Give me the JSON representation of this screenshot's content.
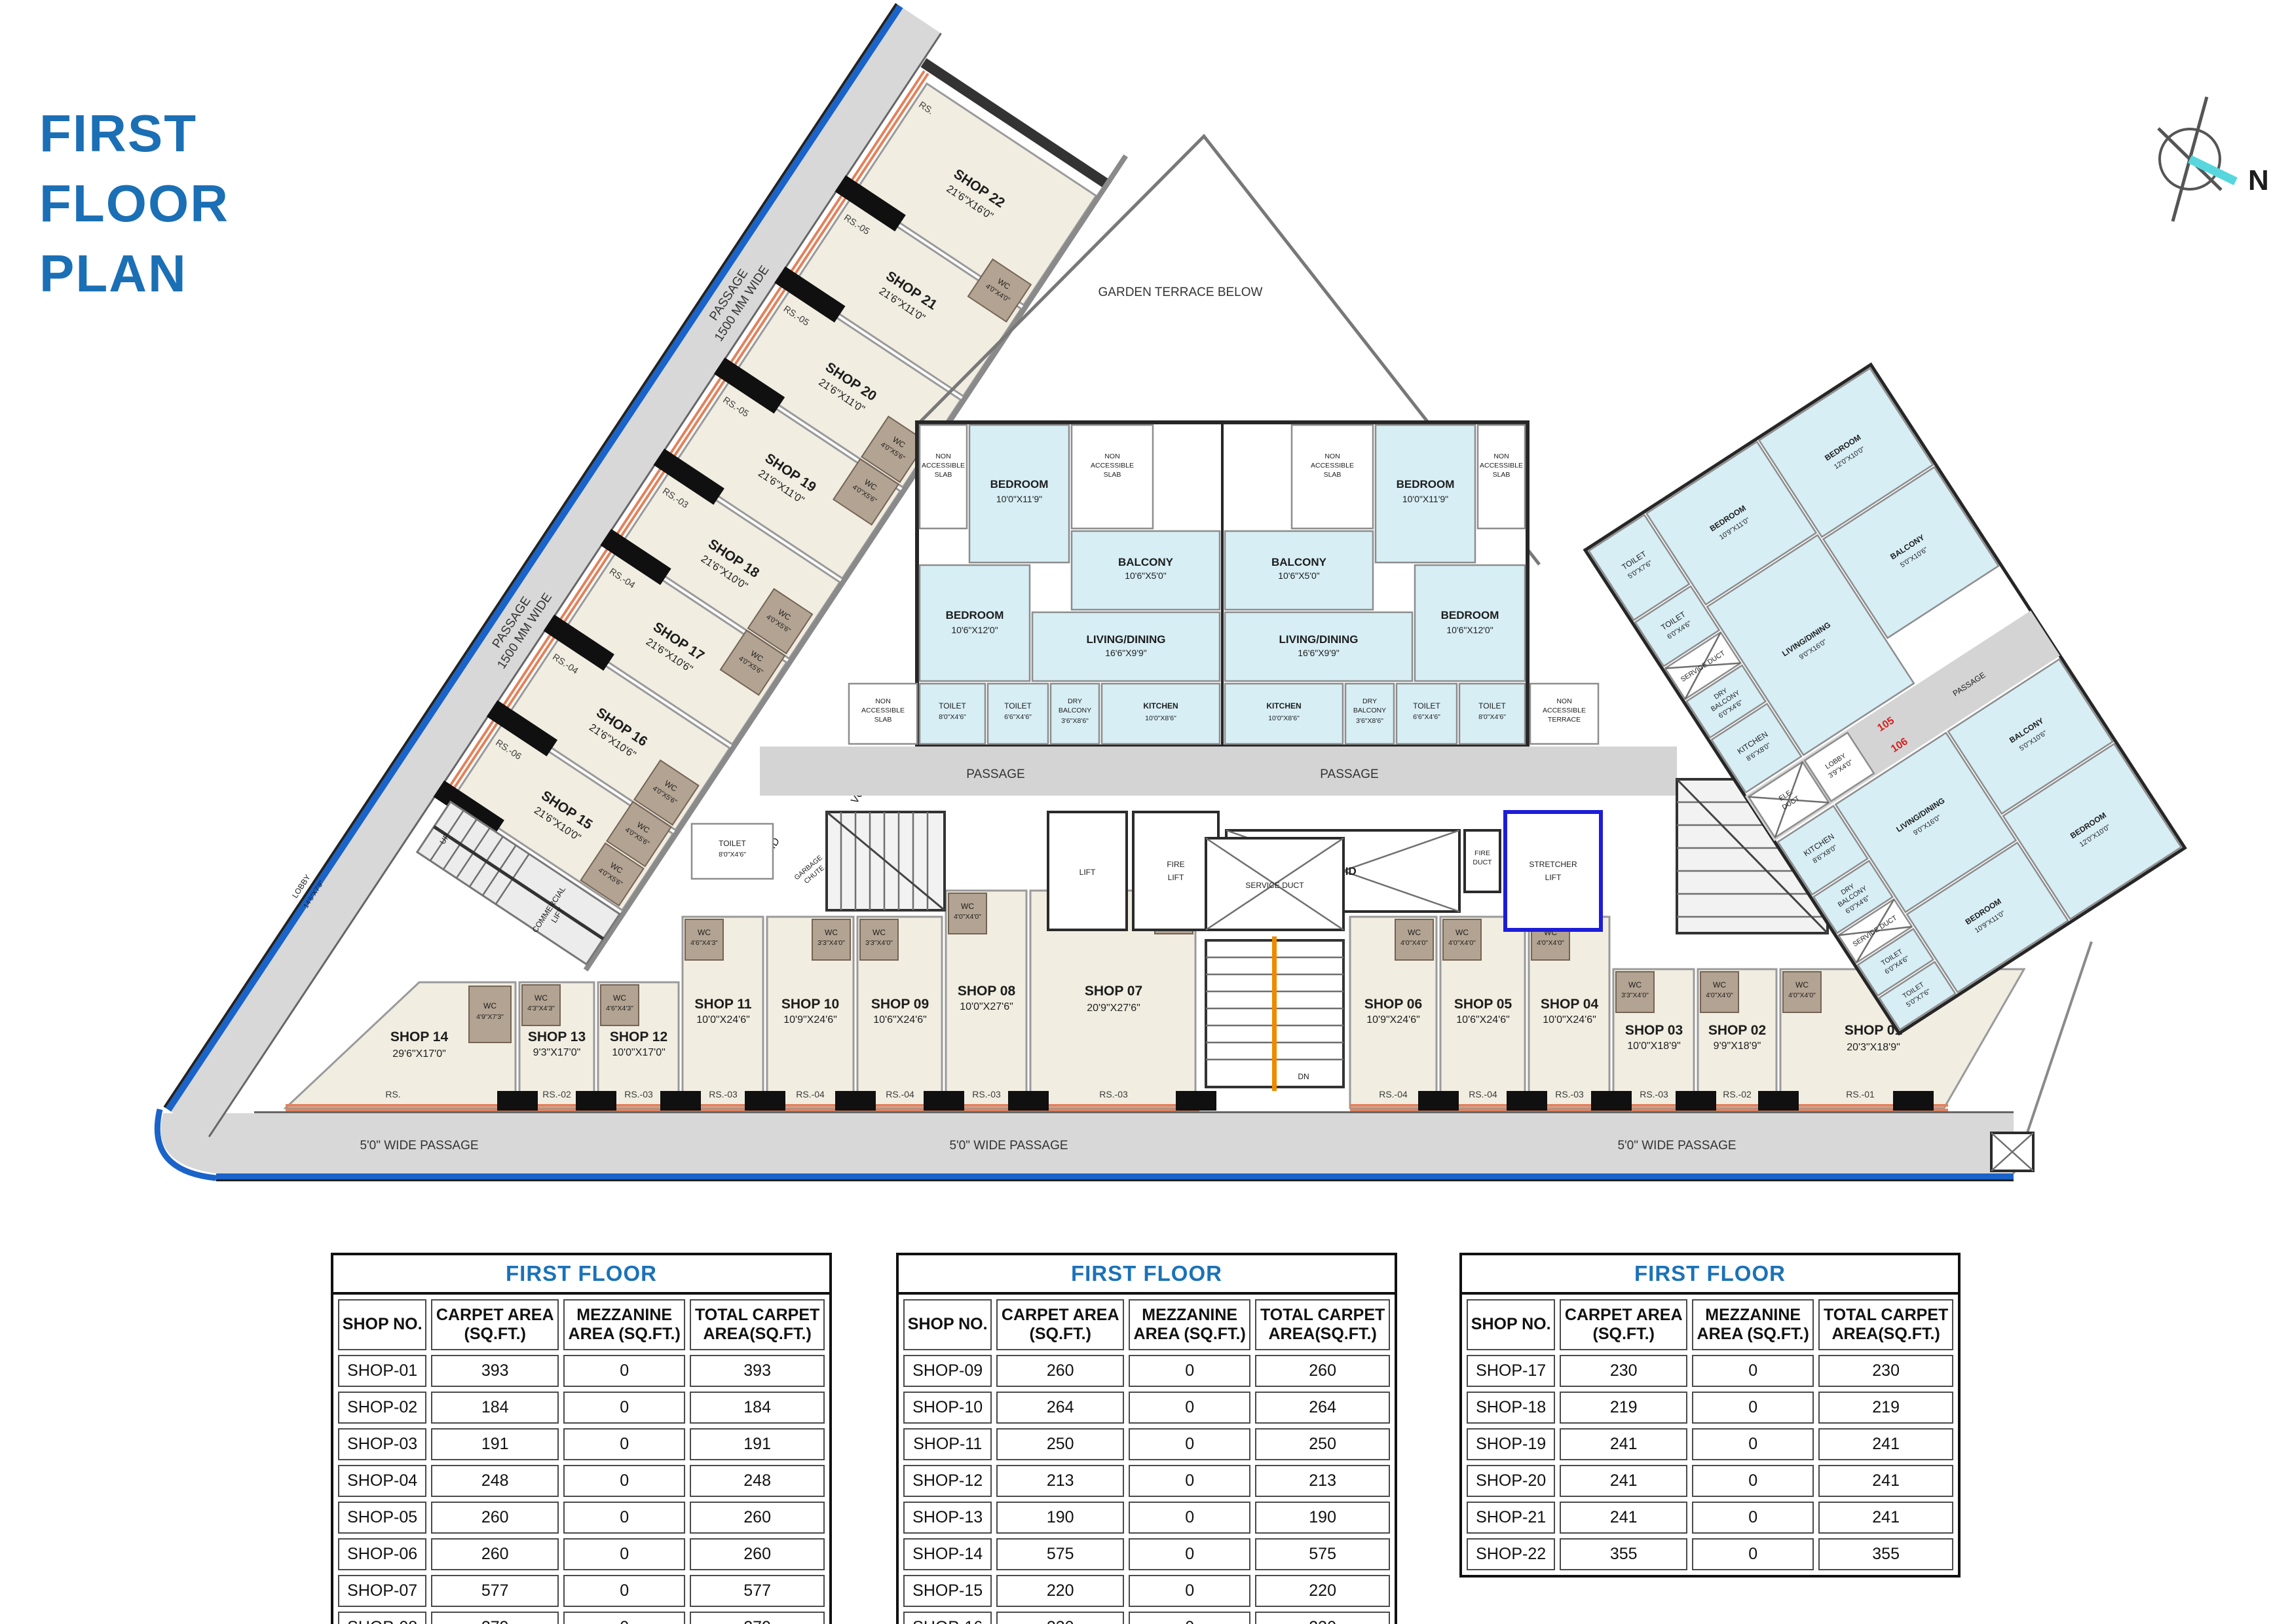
{
  "title": {
    "line1": "FIRST",
    "line2": "FLOOR",
    "line3": "PLAN"
  },
  "compass": {
    "north": "N"
  },
  "plan": {
    "garden_terrace": "GARDEN TERRACE BELOW",
    "passage": "PASSAGE",
    "passage_side_1": "PASSAGE",
    "passage_side_2": "1500 MM WIDE",
    "wide_passage": "5'0\" WIDE PASSAGE",
    "void": "VOID",
    "lift": "LIFT",
    "fire_lift_1": "FIRE",
    "fire_lift_2": "LIFT",
    "fire_duct_1": "FIRE",
    "fire_duct_2": "DUCT",
    "stretcher_1": "STRETCHER",
    "stretcher_2": "LIFT",
    "service_duct": "SERVICE DUCT",
    "garbage_chute_1": "GARBAGE",
    "garbage_chute_2": "CHUTE",
    "commercial_lift_1": "COMMERCIAL",
    "commercial_lift_2": "LIFT",
    "lobby_main_1": "LOBBY",
    "lobby_main_2": "14'6\"X7'9\"",
    "duct": "DUCT",
    "up": "UP",
    "dn": "DN",
    "wc": "WC",
    "toilet_mid_1": "TOILET",
    "toilet_mid_2": "8'0\"X4'6\"",
    "non_acc_1": "NON",
    "non_acc_2": "ACCESSIBLE",
    "non_acc_3": "SLAB",
    "non_acc_t3": "TERRACE",
    "wc_sizes": {
      "s4040": "4'0\"X4'0\"",
      "s4056": "4'0\"X5'6\"",
      "s4973": "4'9\"X7'3\"",
      "s4343": "4'3\"X4'3\"",
      "s4643": "4'6\"X4'3\"",
      "s3340": "3'3\"X4'0\""
    },
    "strip_shops": [
      {
        "name": "SHOP 22",
        "size": "21'6\"X16'0\"",
        "rs": "RS."
      },
      {
        "name": "SHOP 21",
        "size": "21'6\"X11'0\"",
        "rs": "RS.-05"
      },
      {
        "name": "SHOP 20",
        "size": "21'6\"X11'0\"",
        "rs": "RS.-05"
      },
      {
        "name": "SHOP 19",
        "size": "21'6\"X11'0\"",
        "rs": "RS.-05"
      },
      {
        "name": "SHOP 18",
        "size": "21'6\"X10'0\"",
        "rs": "RS.-03"
      },
      {
        "name": "SHOP 17",
        "size": "21'6\"X10'6\"",
        "rs": "RS.-04"
      },
      {
        "name": "SHOP 16",
        "size": "21'6\"X10'6\"",
        "rs": "RS.-04"
      },
      {
        "name": "SHOP 15",
        "size": "21'6\"X10'0\"",
        "rs": "RS.-06"
      }
    ],
    "bottom_shops": [
      {
        "name": "SHOP 14",
        "size": "29'6\"X17'0\"",
        "rs": "RS."
      },
      {
        "name": "SHOP 13",
        "size": "9'3\"X17'0\"",
        "rs": "RS.-02"
      },
      {
        "name": "SHOP 12",
        "size": "10'0\"X17'0\"",
        "rs": "RS.-03"
      },
      {
        "name": "SHOP 11",
        "size": "10'0\"X24'6\"",
        "rs": "RS.-03"
      },
      {
        "name": "SHOP 10",
        "size": "10'9\"X24'6\"",
        "rs": "RS.-04"
      },
      {
        "name": "SHOP 09",
        "size": "10'6\"X24'6\"",
        "rs": "RS.-04"
      },
      {
        "name": "SHOP 08",
        "size": "10'0\"X27'6\"",
        "rs": "RS.-03"
      },
      {
        "name": "SHOP 07",
        "size": "20'9\"X27'6\"",
        "rs": "RS.-03"
      },
      {
        "name": "SHOP 06",
        "size": "10'9\"X24'6\"",
        "rs": "RS.-04"
      },
      {
        "name": "SHOP 05",
        "size": "10'6\"X24'6\"",
        "rs": "RS.-04"
      },
      {
        "name": "SHOP 04",
        "size": "10'0\"X24'6\"",
        "rs": "RS.-03"
      },
      {
        "name": "SHOP 03",
        "size": "10'0\"X18'9\"",
        "rs": "RS.-03"
      },
      {
        "name": "SHOP 02",
        "size": "9'9\"X18'9\"",
        "rs": "RS.-02"
      },
      {
        "name": "SHOP 01",
        "size": "20'3\"X18'9\"",
        "rs": "RS.-01"
      }
    ],
    "central": {
      "bedroom1_1": "BEDROOM",
      "bedroom1_2": "10'0\"X11'9\"",
      "bedroom2_1": "BEDROOM",
      "bedroom2_2": "10'6\"X12'0\"",
      "balcony_1": "BALCONY",
      "balcony_2": "10'6\"X5'0\"",
      "living_1": "LIVING/DINING",
      "living_2": "16'6\"X9'9\"",
      "toilet1_1": "TOILET",
      "toilet1_2": "8'0\"X4'6\"",
      "toilet2_1": "TOILET",
      "toilet2_2": "6'6\"X4'6\"",
      "dry_1": "DRY",
      "dry_2": "BALCONY",
      "dry_3": "3'6\"X8'6\"",
      "kitchen_1": "KITCHEN",
      "kitchen_2": "10'0\"X8'6\"",
      "u103": "103",
      "u104": "104"
    },
    "right": {
      "bedroom_a_1": "BEDROOM",
      "bedroom_a_2": "10'9\"X11'0\"",
      "bedroom_b_1": "BEDROOM",
      "bedroom_b_2": "12'0\"X10'0\"",
      "toilet_a_1": "TOILET",
      "toilet_a_2": "5'0\"X7'6\"",
      "toilet_b_1": "TOILET",
      "toilet_b_2": "6'0\"X4'6\"",
      "dry_1": "DRY",
      "dry_2": "BALCONY",
      "dry_3": "6'0\"X4'6\"",
      "kitchen_1": "KITCHEN",
      "kitchen_2": "8'6\"X8'0\"",
      "living_1": "LIVING/DINING",
      "living_2": "9'0\"X16'0\"",
      "balcony_1": "BALCONY",
      "balcony_2": "5'0\"X10'6\"",
      "lobby_1": "LOBBY",
      "lobby_2": "3'9\"X4'0\"",
      "ele_duct_1": "ELE.",
      "ele_duct_2": "DUCT",
      "u105": "105",
      "u106": "106"
    }
  },
  "tables": {
    "title": "FIRST FLOOR",
    "col1": "SHOP NO.",
    "col2a": "CARPET AREA",
    "col2b": "(SQ.FT.)",
    "col3a": "MEZZANINE",
    "col3b": "AREA (SQ.FT.)",
    "col4a": "TOTAL CARPET",
    "col4b": "AREA(SQ.FT.)",
    "t1": {
      "rows": [
        [
          "SHOP-01",
          "393",
          "0",
          "393"
        ],
        [
          "SHOP-02",
          "184",
          "0",
          "184"
        ],
        [
          "SHOP-03",
          "191",
          "0",
          "191"
        ],
        [
          "SHOP-04",
          "248",
          "0",
          "248"
        ],
        [
          "SHOP-05",
          "260",
          "0",
          "260"
        ],
        [
          "SHOP-06",
          "260",
          "0",
          "260"
        ],
        [
          "SHOP-07",
          "577",
          "0",
          "577"
        ],
        [
          "SHOP-08",
          "279",
          "0",
          "279"
        ]
      ]
    },
    "t2": {
      "rows": [
        [
          "SHOP-09",
          "260",
          "0",
          "260"
        ],
        [
          "SHOP-10",
          "264",
          "0",
          "264"
        ],
        [
          "SHOP-11",
          "250",
          "0",
          "250"
        ],
        [
          "SHOP-12",
          "213",
          "0",
          "213"
        ],
        [
          "SHOP-13",
          "190",
          "0",
          "190"
        ],
        [
          "SHOP-14",
          "575",
          "0",
          "575"
        ],
        [
          "SHOP-15",
          "220",
          "0",
          "220"
        ],
        [
          "SHOP-16",
          "230",
          "0",
          "230"
        ]
      ]
    },
    "t3": {
      "rows": [
        [
          "SHOP-17",
          "230",
          "0",
          "230"
        ],
        [
          "SHOP-18",
          "219",
          "0",
          "219"
        ],
        [
          "SHOP-19",
          "241",
          "0",
          "241"
        ],
        [
          "SHOP-20",
          "241",
          "0",
          "241"
        ],
        [
          "SHOP-21",
          "241",
          "0",
          "241"
        ],
        [
          "SHOP-22",
          "355",
          "0",
          "355"
        ]
      ]
    }
  }
}
